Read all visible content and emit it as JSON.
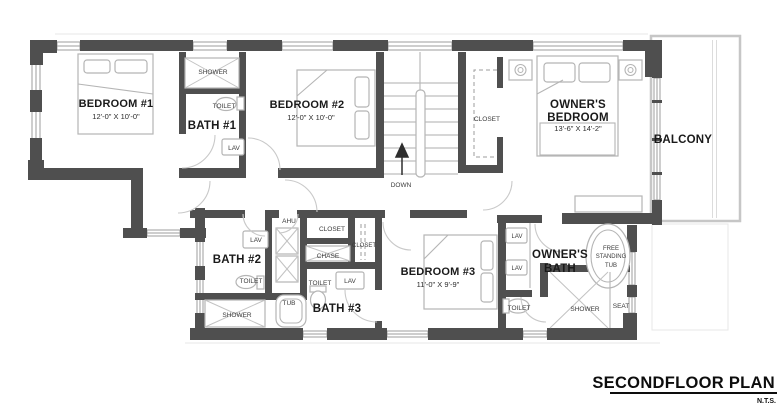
{
  "plan": {
    "title": "SECONDFLOOR PLAN",
    "scale_note": "N.T.S.",
    "rooms": {
      "bedroom1": {
        "name": "BEDROOM #1",
        "dims": "12'-0\" X 10'-0\""
      },
      "bedroom2": {
        "name": "BEDROOM #2",
        "dims": "12'-0\" X 10'-0\""
      },
      "bedroom3": {
        "name": "BEDROOM #3",
        "dims": "11'-0\" X 9'-9\""
      },
      "owners_bedroom": {
        "line1": "OWNER'S",
        "line2": "BEDROOM",
        "dims": "13'-6\" X 14'-2\""
      },
      "bath1": {
        "name": "BATH #1"
      },
      "bath2": {
        "name": "BATH #2"
      },
      "bath3": {
        "name": "BATH #3"
      },
      "owners_bath": {
        "line1": "OWNER'S",
        "line2": "BATH"
      },
      "balcony": {
        "name": "BALCONY"
      },
      "stairs": {
        "direction": "DOWN"
      }
    },
    "fixtures": {
      "bath1_shower": "SHOWER",
      "bath1_toilet": "TOILET",
      "bath1_lav": "LAV",
      "stair_closet": "CLOSET",
      "bath2_lav": "LAV",
      "bath2_toilet": "TOILET",
      "bath2_shower": "SHOWER",
      "ahu": "AHU",
      "closet_a": "CLOSET",
      "chase": "CHASE",
      "closet_b": "CLOSET",
      "bath3_tub": "TUB",
      "bath3_toilet": "TOILET",
      "bath3_lav": "LAV",
      "owners_lav_1": "LAV",
      "owners_lav_2": "LAV",
      "owners_toilet": "TOILET",
      "owners_shower": "SHOWER",
      "owners_seat": "SEAT",
      "free_tub_line1": "FREE",
      "free_tub_line2": "STANDING",
      "free_tub_line3": "TUB"
    },
    "colors": {
      "wall": "#4f4f4f",
      "furniture_outline": "#b5b5b5",
      "text": "#1a1a1a",
      "background": "#ffffff"
    }
  }
}
